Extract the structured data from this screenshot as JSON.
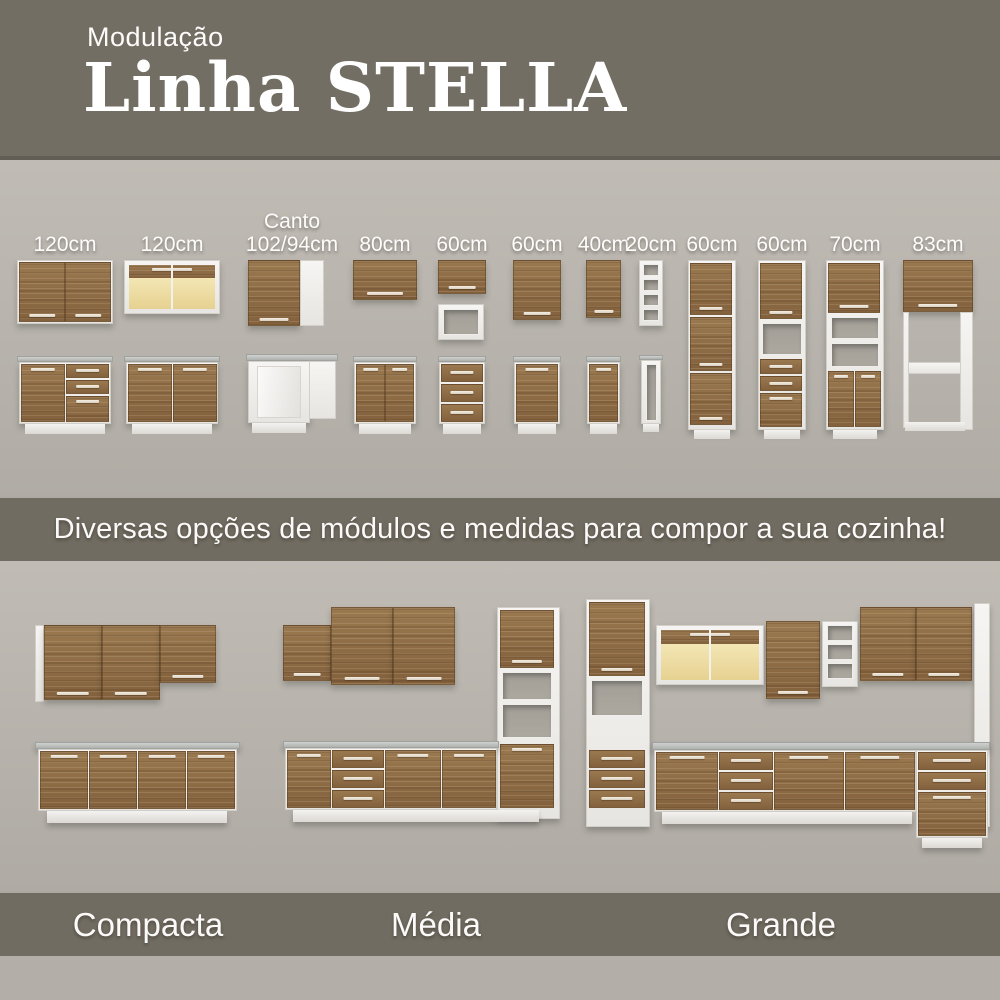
{
  "header": {
    "eyebrow": "Modulação",
    "title": "Linha STELLA"
  },
  "modules": {
    "items": [
      {
        "size": "120cm"
      },
      {
        "size": "120cm"
      },
      {
        "prefix": "Canto",
        "size": "102/94cm"
      },
      {
        "size": "80cm"
      },
      {
        "size": "60cm"
      },
      {
        "size": "60cm"
      },
      {
        "size": "40cm"
      },
      {
        "size": "20cm"
      },
      {
        "size": "60cm"
      },
      {
        "size": "60cm"
      },
      {
        "size": "70cm"
      },
      {
        "size": "83cm"
      }
    ]
  },
  "tagline": "Diversas opções de módulos e medidas para compor a sua cozinha!",
  "kitchens": {
    "labels": [
      "Compacta",
      "Média",
      "Grande"
    ]
  },
  "colors": {
    "band_olive": "#716c61",
    "header_olive": "#736e63",
    "background_gray": "#b4b0a9",
    "wood": "#8d6c45",
    "white_panel": "#f2f1ef",
    "countertop": "#bcbfbb",
    "glass": "#ecd99d",
    "text": "#ffffff"
  }
}
